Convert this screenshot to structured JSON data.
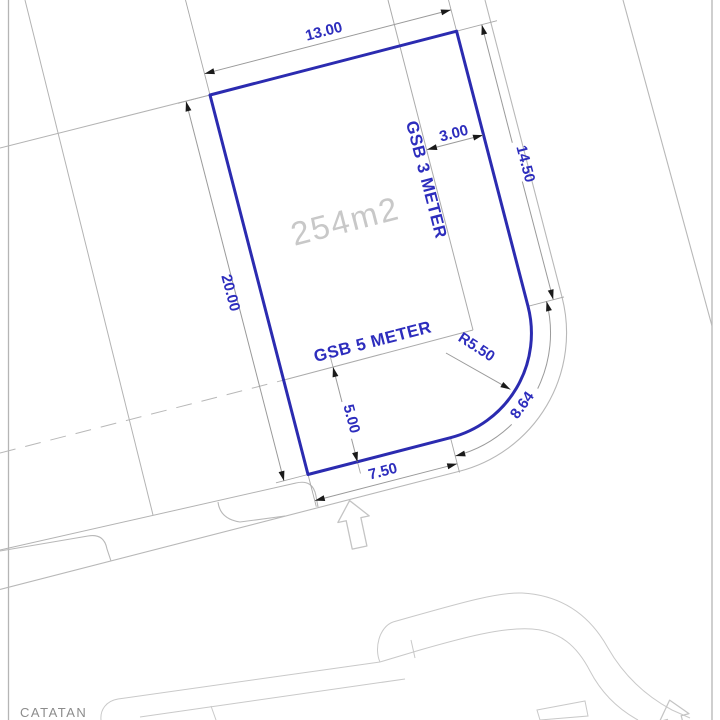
{
  "plot": {
    "area_label": "254m2",
    "setback_label_right": "GSB 3 METER",
    "setback_label_bottom": "GSB 5 METER",
    "dim_top": "13.00",
    "dim_right": "14.50",
    "dim_left": "20.00",
    "dim_bottom": "7.50",
    "dim_setback_right": "3.00",
    "dim_setback_bottom": "5.00",
    "dim_radius": "R5.50",
    "dim_arc_length": "8.64"
  },
  "notes": {
    "title": "CATATAN"
  },
  "colors": {
    "plot_outline": "#2b2bb0",
    "dimension_text": "#2d2dbd",
    "area_text": "#c8c8c8",
    "dimension_lines": "#9a9a9a",
    "road_lines": "#b8b8b8",
    "arrowhead": "#1a1a1a",
    "background": "#ffffff"
  }
}
